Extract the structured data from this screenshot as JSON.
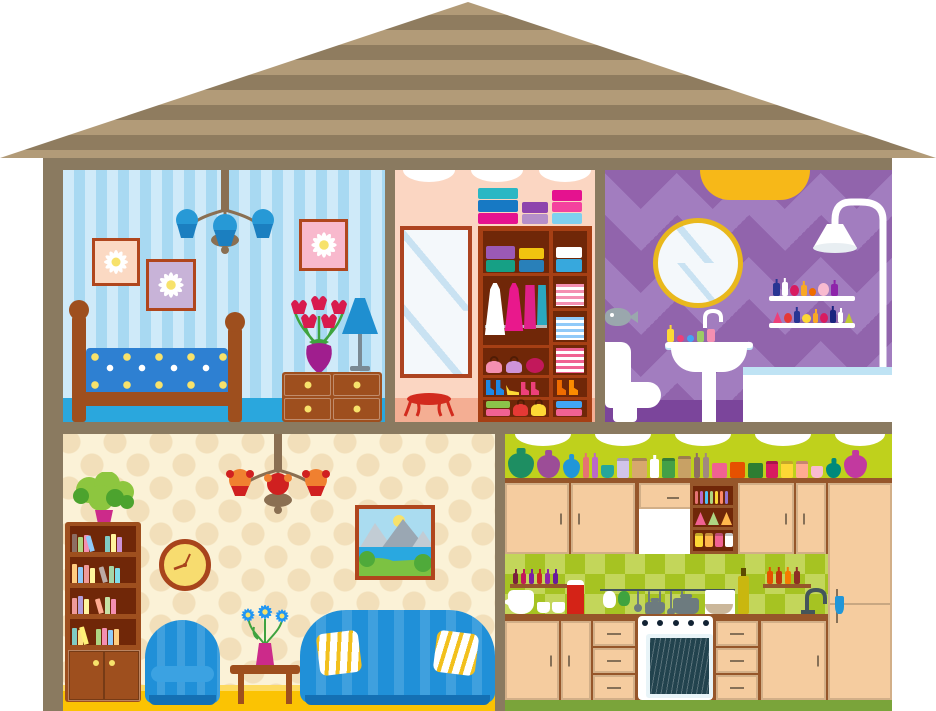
{
  "title": "Cartoon cross-section dollhouse with bedroom, wardrobe closet, bathroom, living room and kitchen",
  "palette": {
    "frame": "#8a7a60",
    "roof_light": "#b29b78",
    "roof_dark": "#8f7c5f",
    "bed_wall_a": "#cfeaf9",
    "bed_wall_b": "#a8d9f2",
    "bed_floor": "#2aa7dd",
    "wood": "#9e4f1e",
    "blanket": "#2e80d2",
    "chand_metal": "#8a6f52",
    "bed_shade": "#2799d6",
    "bed_shade_dark": "#1b7fc0",
    "pic_frame": "#b0461d",
    "pic1_bg": "#fbd9c3",
    "pic2_bg": "#c8b3d8",
    "pic3_bg": "#f8b9cd",
    "daisy_petal": "#ffffff",
    "daisy_center": "#f7e26b",
    "tulip": "#d81b4e",
    "leaf": "#3fa33f",
    "vase_purple": "#a01e8e",
    "lamp_blue": "#1f8fd0",
    "knob": "#f7e26b",
    "closet_wall": "#fbd6c2",
    "closet_floor": "#f4ae93",
    "mirror_frame": "#ad4420",
    "glass": "#f4f8fb",
    "glass_streak": "#c9e2f2",
    "stool_red": "#d22b1e",
    "ward_frame": "#a63f14",
    "ward_inside": "#702708",
    "rod": "#b9b9b9",
    "dress_white": "#ffffff",
    "dress_pink": "#e9188c",
    "skirt_magenta": "#e0218a",
    "pants_teal": "#2aa8bf",
    "bath_a": "#a27dbf",
    "bath_b": "#9164ac",
    "bath_floor": "#7b459b",
    "light_yellow": "#f7b818",
    "mirror_rim": "#e9b81c",
    "tub_water": "#bfe3f4",
    "steel": "#9aa7ad",
    "liv_wall": "#fbf2d7",
    "liv_flower": "#f2dfba",
    "liv_floor": "#fbc303",
    "liv_floor_light": "#fdda60",
    "clock_face": "#f7dc6f",
    "clock_rim": "#a8441c",
    "chair_blue": "#2090d8",
    "chair_stripe": "#3ba2e2",
    "chair_base": "#1470b4",
    "pillow_stripe": "#f2c01d",
    "liv_shade": "#f08030",
    "liv_shade_accent": "#d02020",
    "plant_light": "#8dc63f",
    "plant_dark": "#4ca32e",
    "pot_pink": "#cc2a8a",
    "sky": "#aadcf0",
    "mountain": "#9aa7b3",
    "mountain_light": "#c2ccd4",
    "sea": "#29a8e0",
    "grass": "#7cc242",
    "bush": "#4faa3a",
    "sun": "#f7e26b",
    "kit_wall": "#bfd11c",
    "kit_check_a": "#a6c322",
    "kit_check_b": "#c3d65a",
    "kit_cab": "#f5cc9f",
    "kit_trim": "#96562a",
    "kit_floor": "#7aa43a",
    "oven_dark": "#22434e",
    "steel2": "#6d7b7f",
    "oil": "#c9b70f",
    "red_pitcher": "#d42317"
  },
  "rooms": {
    "bedroom": {
      "name": "bedroom",
      "objects": "chandelier, three daisy pictures, bed with floral blanket, dresser, tulip vase, table lamp"
    },
    "closet": {
      "name": "walk-in closet",
      "objects": "tall mirror, stool, wardrobe with boxes, hanging dresses, folded clothes, bags and shoes"
    },
    "bathroom": {
      "name": "bathroom",
      "objects": "ceiling light, round mirror, perfume shelves, shower, bathtub, toilet, pedestal sink"
    },
    "living": {
      "name": "living room",
      "objects": "chandelier, bookcase with plant, wall clock, landscape painting, armchair, coffee table with flowers, sofa with pillows"
    },
    "kitchen": {
      "name": "kitchen",
      "objects": "top shelf with jars and jugs, cabinets, extractor hood, open shelves, spice racks, utensil rail, stove with oven, sink"
    }
  },
  "closet_items": {
    "top_stacks": [
      {
        "t": "stack",
        "n": "box-stack",
        "items": [
          {
            "t": "box",
            "c": "#2ab7c4",
            "w": 40,
            "h": 11
          },
          {
            "t": "box",
            "c": "#1779c4",
            "w": 40,
            "h": 12
          },
          {
            "t": "box",
            "c": "#e5128f",
            "w": 40,
            "h": 11
          }
        ]
      },
      {
        "t": "stack",
        "n": "box-stack",
        "items": [
          {
            "t": "box",
            "c": "#8e44ad",
            "w": 26,
            "h": 11
          },
          {
            "t": "box",
            "c": "#b58fc9",
            "w": 26,
            "h": 10
          }
        ]
      },
      {
        "t": "stack",
        "n": "box-stack",
        "items": [
          {
            "t": "box",
            "c": "#e5128f",
            "w": 30,
            "h": 11
          },
          {
            "t": "box",
            "c": "#f4429e",
            "w": 30,
            "h": 10
          },
          {
            "t": "box",
            "c": "#7fd0ef",
            "w": 30,
            "h": 11
          }
        ]
      }
    ],
    "row1": [
      {
        "t": "stack",
        "n": "suitcases",
        "items": [
          {
            "t": "box",
            "c": "#9b59b6",
            "w": 29,
            "h": 13
          },
          {
            "t": "box",
            "c": "#16a085",
            "w": 29,
            "h": 12
          }
        ]
      },
      {
        "t": "stack",
        "n": "boxes",
        "items": [
          {
            "t": "box",
            "c": "#f1c40f",
            "w": 25,
            "h": 11
          },
          {
            "t": "box",
            "c": "#2980b9",
            "w": 25,
            "h": 12
          }
        ]
      }
    ],
    "right1": [
      {
        "t": "stack",
        "n": "boxes",
        "items": [
          {
            "t": "box",
            "c": "#ffffff",
            "w": 26,
            "h": 11
          },
          {
            "t": "box",
            "c": "#37a8dd",
            "w": 26,
            "h": 13
          }
        ]
      }
    ],
    "stripe_row1": [
      {
        "t": "stripes",
        "n": "folded-clothes",
        "c": "#ffffff",
        "c2": "#f48fb1",
        "w": 28,
        "h": 22
      }
    ],
    "stripe_row2": [
      {
        "t": "stripes",
        "n": "folded-clothes",
        "c": "#ffffff",
        "c2": "#90caf9",
        "w": 28,
        "h": 23
      }
    ],
    "stripe_row3": [
      {
        "t": "stripes",
        "n": "folded-clothes",
        "c": "#ffffff",
        "c2": "#f06292",
        "w": 28,
        "h": 25
      }
    ],
    "bags": [
      {
        "t": "bag",
        "n": "purse",
        "c": "#f48fb1",
        "w": 16,
        "h": 12
      },
      {
        "t": "bag",
        "n": "purse",
        "c": "#ce93d8",
        "w": 16,
        "h": 12
      },
      {
        "t": "round",
        "n": "hat",
        "c": "#c2185b",
        "w": 18,
        "h": 15
      }
    ],
    "shoes": [
      {
        "t": "boot",
        "n": "boot",
        "c": "#1e88e5",
        "w": 8,
        "h": 15
      },
      {
        "t": "boot",
        "n": "boot",
        "c": "#1e88e5",
        "w": 8,
        "h": 15
      },
      {
        "t": "heel",
        "n": "heel",
        "c": "#fdd835",
        "w": 13,
        "h": 10
      },
      {
        "t": "boot",
        "n": "boot",
        "c": "#ec407a",
        "w": 8,
        "h": 13
      },
      {
        "t": "boot",
        "n": "boot",
        "c": "#ec407a",
        "w": 8,
        "h": 13
      }
    ],
    "bottom": [
      {
        "t": "stack",
        "n": "boxes",
        "items": [
          {
            "t": "box",
            "c": "#8bc34a",
            "w": 24,
            "h": 7
          },
          {
            "t": "box",
            "c": "#f06292",
            "w": 24,
            "h": 7
          }
        ]
      },
      {
        "t": "bag",
        "n": "handbag",
        "c": "#e53935",
        "w": 15,
        "h": 12
      },
      {
        "t": "bag",
        "n": "handbag",
        "c": "#fdd835",
        "w": 15,
        "h": 12
      }
    ],
    "right_boots": [
      {
        "t": "boot",
        "n": "boot",
        "c": "#ef6c00",
        "w": 9,
        "h": 15
      },
      {
        "t": "boot",
        "n": "boot",
        "c": "#fb8c00",
        "w": 9,
        "h": 15
      }
    ],
    "right_bottom": [
      {
        "t": "stack",
        "n": "boxes",
        "items": [
          {
            "t": "box",
            "c": "#42a5f5",
            "w": 26,
            "h": 7
          },
          {
            "t": "box",
            "c": "#f06292",
            "w": 26,
            "h": 7
          }
        ]
      }
    ]
  },
  "bath_items": {
    "shelf1": [
      {
        "t": "bottle",
        "n": "perfume",
        "c": "#283593",
        "w": 7,
        "h": 13
      },
      {
        "t": "bottle",
        "n": "perfume",
        "c": "#ffffff",
        "w": 6,
        "h": 14
      },
      {
        "t": "round",
        "n": "perfume",
        "c": "#d81b60",
        "w": 9,
        "h": 11
      },
      {
        "t": "bottle",
        "n": "perfume",
        "c": "#f9a825",
        "w": 6,
        "h": 11
      },
      {
        "t": "round",
        "n": "perfume",
        "c": "#ef6c00",
        "w": 7,
        "h": 8
      },
      {
        "t": "round",
        "n": "perfume",
        "c": "#f8bbd0",
        "w": 11,
        "h": 13
      },
      {
        "t": "bottle",
        "n": "perfume",
        "c": "#8e24aa",
        "w": 7,
        "h": 12
      }
    ],
    "shelf2": [
      {
        "t": "tri",
        "n": "perfume",
        "c": "#ec407a",
        "w": 9,
        "h": 11
      },
      {
        "t": "round",
        "n": "perfume",
        "c": "#e53935",
        "w": 8,
        "h": 10
      },
      {
        "t": "bottle",
        "n": "perfume",
        "c": "#283593",
        "w": 6,
        "h": 12
      },
      {
        "t": "round",
        "n": "perfume",
        "c": "#fdd835",
        "w": 9,
        "h": 9
      },
      {
        "t": "bottle",
        "n": "perfume",
        "c": "#f9a825",
        "w": 5,
        "h": 10
      },
      {
        "t": "round",
        "n": "perfume",
        "c": "#d81b60",
        "w": 8,
        "h": 10
      },
      {
        "t": "bottle",
        "n": "perfume",
        "c": "#1a237e",
        "w": 6,
        "h": 13
      },
      {
        "t": "bottle",
        "n": "perfume",
        "c": "#ffffff",
        "w": 5,
        "h": 11
      },
      {
        "t": "tri",
        "n": "perfume",
        "c": "#c0ca33",
        "w": 8,
        "h": 10
      }
    ],
    "sink_items": [
      {
        "t": "bottle",
        "n": "soap",
        "c": "#fdd835",
        "w": 7,
        "h": 13
      },
      {
        "t": "round",
        "n": "flower-soap",
        "c": "#ec407a",
        "w": 7,
        "h": 7
      },
      {
        "t": "round",
        "n": "flower-soap",
        "c": "#42a5f5",
        "w": 7,
        "h": 7
      },
      {
        "t": "rect",
        "n": "tube",
        "c": "#9ccc65",
        "w": 7,
        "h": 11
      },
      {
        "t": "rect",
        "n": "tube",
        "c": "#f48fb1",
        "w": 8,
        "h": 13
      }
    ]
  },
  "living_items": {
    "shelf1": [
      {
        "t": "book",
        "c": "#8d6e63",
        "w": 5,
        "h": 18
      },
      {
        "t": "book",
        "c": "#aed581",
        "w": 5,
        "h": 15
      },
      {
        "t": "book",
        "c": "#f48fb1",
        "w": 5,
        "h": 17
      },
      {
        "t": "book tilt",
        "c": "#90caf9",
        "w": 5,
        "h": 16
      },
      {
        "t": "rect",
        "c": "transparent",
        "w": 8,
        "h": 4
      },
      {
        "t": "book",
        "c": "#80cbc4",
        "w": 5,
        "h": 16
      },
      {
        "t": "book",
        "c": "#fff59d",
        "w": 5,
        "h": 18
      },
      {
        "t": "book",
        "c": "#ce93d8",
        "w": 5,
        "h": 15
      }
    ],
    "shelf2": [
      {
        "t": "book",
        "c": "#ffcc80",
        "w": 5,
        "h": 19
      },
      {
        "t": "book",
        "c": "#90caf9",
        "w": 5,
        "h": 16
      },
      {
        "t": "book",
        "c": "#ef9a9a",
        "w": 5,
        "h": 18
      },
      {
        "t": "book",
        "c": "#fff59d",
        "w": 5,
        "h": 15
      },
      {
        "t": "rect",
        "c": "transparent",
        "w": 6,
        "h": 4
      },
      {
        "t": "book tilt",
        "c": "#bcaaa4",
        "w": 5,
        "h": 16
      },
      {
        "t": "book",
        "c": "#a5d6a7",
        "w": 5,
        "h": 17
      },
      {
        "t": "book",
        "c": "#80deea",
        "w": 5,
        "h": 15
      }
    ],
    "shelf3": [
      {
        "t": "book",
        "c": "#ef9a9a",
        "w": 5,
        "h": 16
      },
      {
        "t": "book",
        "c": "#b39ddb",
        "w": 5,
        "h": 18
      },
      {
        "t": "book",
        "c": "#fff59d",
        "w": 5,
        "h": 15
      },
      {
        "t": "rect",
        "c": "transparent",
        "w": 8,
        "h": 4
      },
      {
        "t": "book tilt",
        "c": "#ffab91",
        "w": 5,
        "h": 15
      },
      {
        "t": "book",
        "c": "#c5e1a5",
        "w": 5,
        "h": 17
      },
      {
        "t": "book",
        "c": "#f48fb1",
        "w": 5,
        "h": 15
      }
    ],
    "shelf4": [
      {
        "t": "book",
        "c": "#80cbc4",
        "w": 5,
        "h": 17
      },
      {
        "t": "book",
        "c": "#ffe082",
        "w": 5,
        "h": 15
      },
      {
        "t": "book tilt",
        "c": "#fff176",
        "w": 5,
        "h": 18
      },
      {
        "t": "rect",
        "c": "transparent",
        "w": 5,
        "h": 4
      },
      {
        "t": "book",
        "c": "#aed581",
        "w": 5,
        "h": 16
      },
      {
        "t": "book",
        "c": "#f48fb1",
        "w": 5,
        "h": 17
      },
      {
        "t": "book",
        "c": "#90caf9",
        "w": 5,
        "h": 15
      },
      {
        "t": "book",
        "c": "#ffcc80",
        "w": 5,
        "h": 16
      }
    ]
  },
  "kitchen_items": {
    "top_shelf": [
      {
        "t": "jug",
        "n": "jug",
        "c": "#1e8e62",
        "w": 26,
        "h": 25
      },
      {
        "t": "jug",
        "n": "jug",
        "c": "#9c4d97",
        "w": 23,
        "h": 23
      },
      {
        "t": "jug",
        "n": "jug",
        "c": "#2196d8",
        "w": 17,
        "h": 19
      },
      {
        "t": "bottle",
        "n": "bottle",
        "c": "#e57373",
        "w": 6,
        "h": 21
      },
      {
        "t": "bottle",
        "n": "bottle",
        "c": "#ba68c8",
        "w": 6,
        "h": 21
      },
      {
        "t": "cup",
        "n": "cup",
        "c": "#26a69a",
        "w": 13,
        "h": 13
      },
      {
        "t": "jar",
        "n": "jar",
        "c": "#d1c4e9",
        "w": 12,
        "h": 17
      },
      {
        "t": "jar",
        "n": "jar",
        "c": "#d7a86e",
        "w": 15,
        "h": 17
      },
      {
        "t": "bottle",
        "n": "bottle",
        "c": "#ffffff",
        "w": 9,
        "h": 19
      },
      {
        "t": "jar",
        "n": "jar",
        "c": "#43a047",
        "w": 13,
        "h": 17
      },
      {
        "t": "jar",
        "n": "jar",
        "c": "#c8a165",
        "w": 13,
        "h": 19
      },
      {
        "t": "bottle",
        "n": "bottle",
        "c": "#8d6e63",
        "w": 6,
        "h": 21
      },
      {
        "t": "bottle",
        "n": "bottle",
        "c": "#a1887f",
        "w": 6,
        "h": 21
      },
      {
        "t": "box",
        "n": "tin",
        "c": "#f06292",
        "w": 15,
        "h": 15
      },
      {
        "t": "box",
        "n": "tin",
        "c": "#e65100",
        "w": 15,
        "h": 16
      },
      {
        "t": "box",
        "n": "tin",
        "c": "#2e7d32",
        "w": 15,
        "h": 15
      },
      {
        "t": "jar",
        "n": "jar",
        "c": "#d81b60",
        "w": 12,
        "h": 14
      },
      {
        "t": "jar",
        "n": "jar",
        "c": "#fdd835",
        "w": 12,
        "h": 14
      },
      {
        "t": "jar",
        "n": "jar",
        "c": "#ffab91",
        "w": 12,
        "h": 14
      },
      {
        "t": "cup",
        "n": "cup",
        "c": "#f8bbd0",
        "w": 12,
        "h": 12
      },
      {
        "t": "jug",
        "n": "jug",
        "c": "#00897b",
        "w": 15,
        "h": 15
      },
      {
        "t": "jug",
        "n": "jug",
        "c": "#c2399f",
        "w": 23,
        "h": 23
      }
    ],
    "open_r1": [
      {
        "t": "rect",
        "c": "#e57373",
        "w": 3,
        "h": 13
      },
      {
        "t": "rect",
        "c": "#ba68c8",
        "w": 3,
        "h": 13
      },
      {
        "t": "rect",
        "c": "#4fc3f7",
        "w": 3,
        "h": 13
      },
      {
        "t": "rect",
        "c": "#aed581",
        "w": 3,
        "h": 13
      },
      {
        "t": "rect",
        "c": "#fdd835",
        "w": 3,
        "h": 13
      },
      {
        "t": "rect",
        "c": "#ff8a65",
        "w": 3,
        "h": 13
      },
      {
        "t": "rect",
        "c": "#9575cd",
        "w": 3,
        "h": 13
      }
    ],
    "open_r2": [
      {
        "t": "tri",
        "n": "bag",
        "c": "#f06292",
        "w": 11,
        "h": 13
      },
      {
        "t": "tri",
        "n": "bag",
        "c": "#aed581",
        "w": 11,
        "h": 13
      },
      {
        "t": "tri",
        "n": "bag",
        "c": "#ffb74d",
        "w": 11,
        "h": 13
      }
    ],
    "open_r3": [
      {
        "t": "jar",
        "c": "#fdd835",
        "w": 8,
        "h": 11
      },
      {
        "t": "jar",
        "c": "#ffb74d",
        "w": 8,
        "h": 11
      },
      {
        "t": "jar",
        "c": "#f06292",
        "w": 8,
        "h": 11
      },
      {
        "t": "jar",
        "c": "#ffffff",
        "w": 8,
        "h": 11
      }
    ],
    "spice_left": [
      {
        "t": "bottle",
        "c": "#7a1f3d",
        "w": 5,
        "h": 11
      },
      {
        "t": "bottle",
        "c": "#c2185b",
        "w": 5,
        "h": 11
      },
      {
        "t": "bottle",
        "c": "#7b1fa2",
        "w": 5,
        "h": 11
      },
      {
        "t": "bottle",
        "c": "#c62828",
        "w": 5,
        "h": 11
      },
      {
        "t": "bottle",
        "c": "#8e24aa",
        "w": 5,
        "h": 11
      },
      {
        "t": "bottle",
        "c": "#6a1b9a",
        "w": 5,
        "h": 11
      }
    ],
    "spice_right": [
      {
        "t": "bottle",
        "c": "#e65100",
        "w": 6,
        "h": 13
      },
      {
        "t": "bottle",
        "c": "#bf360c",
        "w": 6,
        "h": 13
      },
      {
        "t": "bottle",
        "c": "#f57c00",
        "w": 6,
        "h": 13
      },
      {
        "t": "bottle",
        "c": "#8d2f23",
        "w": 6,
        "h": 13
      }
    ],
    "utensils": [
      {
        "t": "utensil",
        "c": "#6d7b7f",
        "w": 2,
        "h": 14
      },
      {
        "t": "utensil",
        "c": "#6d7b7f",
        "w": 2,
        "h": 17
      },
      {
        "t": "utensil",
        "c": "#6d7b7f",
        "w": 2,
        "h": 15
      },
      {
        "t": "utensil",
        "c": "#6d7b7f",
        "w": 2,
        "h": 18
      },
      {
        "t": "utensil",
        "c": "#6d7b7f",
        "w": 2,
        "h": 15
      }
    ]
  }
}
